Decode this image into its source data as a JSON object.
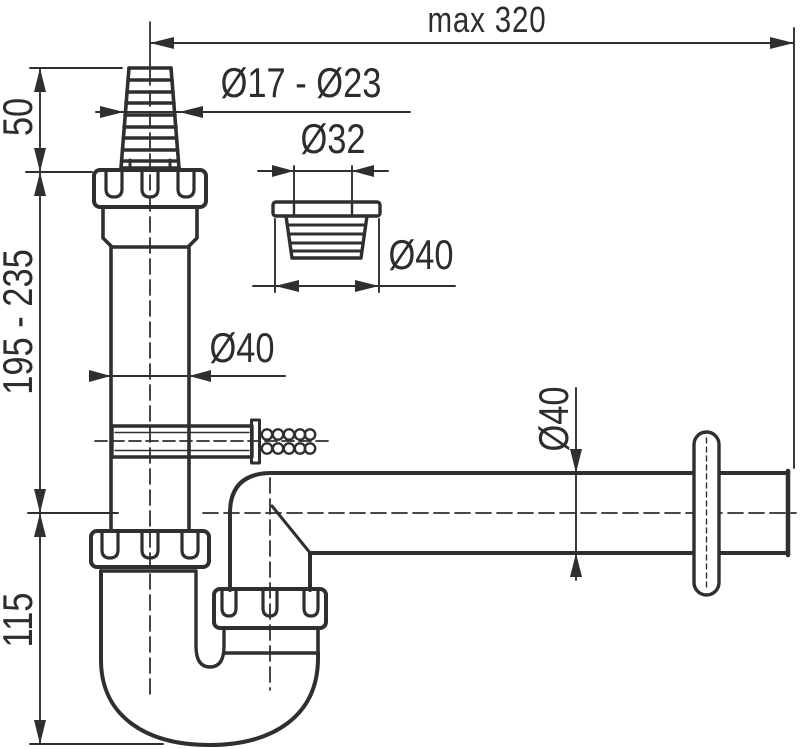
{
  "drawing": {
    "background_color": "#ffffff",
    "line_color": "#2f2f2f",
    "labels": {
      "overall_width": "max 320",
      "hose_range": "Ø17 - Ø23",
      "reducer_top": "Ø32",
      "reducer_bottom": "Ø40",
      "pipe_dia": "Ø40",
      "outlet_dia": "Ø40",
      "cone_height": "50",
      "height_range": "195 - 235",
      "trap_depth": "115"
    }
  }
}
